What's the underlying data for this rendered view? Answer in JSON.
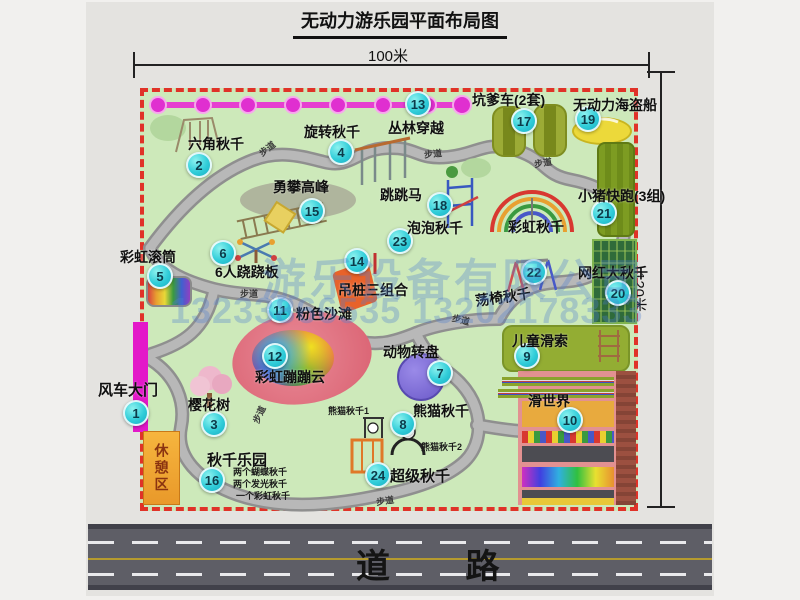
{
  "title": "无动力游乐园平面布局图",
  "dims": {
    "top": "100米",
    "right": "120米"
  },
  "road": {
    "label": "道 路"
  },
  "watermark": {
    "company": "游乐设备有限公司",
    "phones": "13233866535 13202178333"
  },
  "labels": {
    "rainbow_swing": "彩虹秋千",
    "panda_swing_1": "熊猫秋千1",
    "panda_swing_2": "熊猫秋千2",
    "rest_area": "休憩区",
    "path": "步道",
    "swing_park_items": [
      "两个蝴蝶秋千",
      "两个发光秋千",
      "一个彩虹秋千"
    ]
  },
  "attractions": [
    {
      "num": "1",
      "name": "风车大门"
    },
    {
      "num": "2",
      "name": "六角秋千"
    },
    {
      "num": "3",
      "name": "樱花树"
    },
    {
      "num": "4",
      "name": "旋转秋千"
    },
    {
      "num": "5",
      "name": "彩虹滚筒"
    },
    {
      "num": "6",
      "name": "6人跷跷板"
    },
    {
      "num": "7",
      "name": "动物转盘"
    },
    {
      "num": "8",
      "name": "熊猫秋千"
    },
    {
      "num": "9",
      "name": "儿童滑索"
    },
    {
      "num": "10",
      "name": "滑世界"
    },
    {
      "num": "11",
      "name": "粉色沙滩"
    },
    {
      "num": "12",
      "name": "彩虹蹦蹦云"
    },
    {
      "num": "13",
      "name": "丛林穿越"
    },
    {
      "num": "14",
      "name": "吊桩三组合"
    },
    {
      "num": "15",
      "name": "勇攀高峰"
    },
    {
      "num": "16",
      "name": "秋千乐园"
    },
    {
      "num": "17",
      "name": "坑爹车(2套)"
    },
    {
      "num": "18",
      "name": "跳跳马"
    },
    {
      "num": "19",
      "name": "无动力海盗船"
    },
    {
      "num": "20",
      "name": "网红大秋千"
    },
    {
      "num": "21",
      "name": "小猪快跑(3组)"
    },
    {
      "num": "22",
      "name": "荡椅秋千"
    },
    {
      "num": "23",
      "name": "泡泡秋千"
    },
    {
      "num": "24",
      "name": "超级秋千"
    }
  ],
  "colors": {
    "boundary_red": "#e03228",
    "park_green": "#cde9ba",
    "badge_cyan": "#31cdd9",
    "gate_magenta": "#e318c9",
    "road_gray": "#5e5e66",
    "watermark_blue": "#4f7fd0"
  }
}
